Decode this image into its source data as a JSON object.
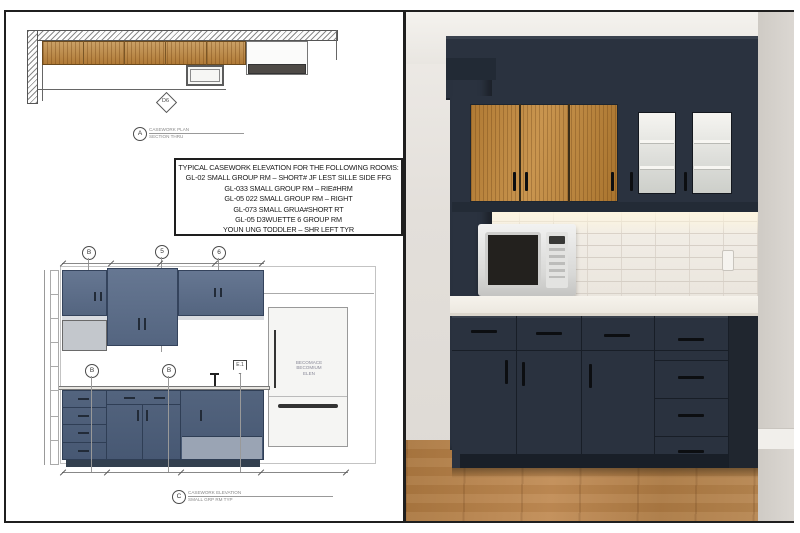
{
  "palette": {
    "frame_border": "#1f1f1f",
    "elevation_cabinet": "#5c6d89",
    "photo_cabinet_navy": "#2a323f",
    "wood_tone": "#b5803d",
    "countertop": "#f3efe8",
    "tile": "#ebe6df",
    "floor_wood": "#b5824e",
    "wall": "#ddd9d4"
  },
  "drawing": {
    "plan": {
      "detail_tag": "D6",
      "section_marker": {
        "label": "A",
        "caption_line1": "CASEWORK PLAN",
        "caption_line2": "SECTION THRU"
      }
    },
    "note_box": {
      "title": "TYPICAL CASEWORK ELEVATION FOR THE FOLLOWING ROOMS:",
      "lines": [
        "GL-02 SMALL GROUP RM – SHORT# JF LEST SILLE SIDE FFG",
        "GL-033 SMALL GROUP RM – RIE#HRM",
        "GL-05 022 SMALL GROUP RM – RIGHT",
        "GL-073 SMALL GRUA#SHORT RT",
        "GL-05 D3WUETTE 6 GROUP RM",
        "YOUN UNG TODDLER – SHR LEFT TYR"
      ]
    },
    "elevation": {
      "grid_bubbles_top": [
        "B",
        "5",
        "6"
      ],
      "callouts_bottom": [
        "B",
        "B"
      ],
      "keynote_tag": "E.1",
      "fridge_label_lines": [
        "BECOMACE",
        "BECOMIUM",
        "ELEN"
      ],
      "section_marker": {
        "label": "C",
        "caption_line1": "CASEWORK ELEVATION",
        "caption_line2": "SMALL GRP RM TYP"
      }
    }
  },
  "photo": {
    "description": "rendered kitchenette: navy cabinets, wood uppers, glass doors, white microwave"
  }
}
